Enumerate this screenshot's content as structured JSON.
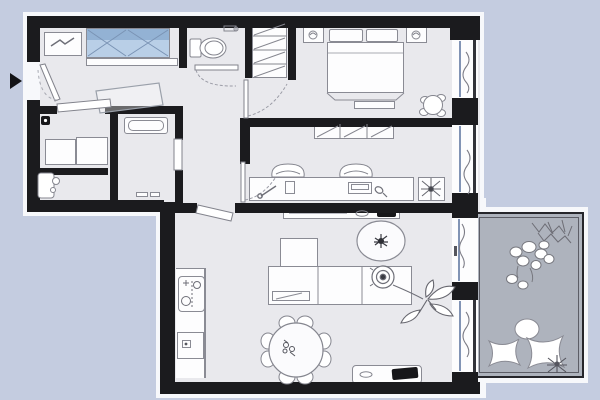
{
  "meta": {
    "kind": "apartment-floor-plan",
    "view": "top-down",
    "text_labels": []
  },
  "palette": {
    "bg": "#c4cce0",
    "glow": "#f7f8fb",
    "floor": "#e9e9ed",
    "balcony": "#aeb3bd",
    "wall": "#1b1b1e",
    "line": "#8a8b94",
    "lineDark": "#55565e",
    "white": "#fdfdfe",
    "glass": "#8294b5",
    "wardrobeBlue": "#b9cfe7",
    "wardrobeBlueDark": "#93b2d4"
  },
  "entrance": {
    "marker": "black-triangle-arrow",
    "side": "left-wall"
  },
  "rooms": [
    {
      "id": "entry-hall",
      "furniture": [
        "shoe-cabinet",
        "blue-wardrobe",
        "shelf-bench",
        "door-mat"
      ]
    },
    {
      "id": "wc",
      "furniture": [
        "toilet",
        "paper-holder"
      ]
    },
    {
      "id": "hall-closet",
      "furniture": [
        "shelved-closet"
      ]
    },
    {
      "id": "bedroom",
      "furniture": [
        "double-bed",
        "pillow",
        "pillow",
        "nightstand-left",
        "nightstand-right",
        "lamp",
        "lamp",
        "foot-bench",
        "round-chair"
      ]
    },
    {
      "id": "bathroom",
      "furniture": [
        "vanity-cabinet",
        "vanity-cabinet",
        "wall-box",
        "sink-fixture"
      ]
    },
    {
      "id": "small-bathroom",
      "furniture": [
        "bathtub",
        "floor-vent"
      ]
    },
    {
      "id": "study",
      "furniture": [
        "hatched-wardrobe",
        "desk",
        "chair",
        "chair",
        "desk-lamp",
        "organizer",
        "laptop",
        "mouse",
        "potted-plant"
      ]
    },
    {
      "id": "living-kitchen",
      "furniture": [
        "kitchen-counter",
        "sink-unit",
        "stove",
        "dining-table",
        "dining-chairs",
        "sideboard",
        "speaker",
        "coffee-table-plant",
        "corner-armchair",
        "sectional-sofa",
        "table-lamp",
        "floor-plant",
        "tv-stand",
        "tv"
      ]
    },
    {
      "id": "balcony",
      "furniture": [
        "plant-cluster",
        "white-flower-cluster",
        "round-cushion",
        "star-cushion",
        "star-cushion",
        "small-dark-plant"
      ]
    }
  ],
  "windows": [
    "bedroom-window",
    "study-window",
    "balcony-glass-door",
    "living-room-window"
  ],
  "doors": [
    "entrance-door",
    "wc-door",
    "bedroom-door",
    "bathroom-door",
    "small-bathroom-door",
    "study-door",
    "living-room-door"
  ]
}
